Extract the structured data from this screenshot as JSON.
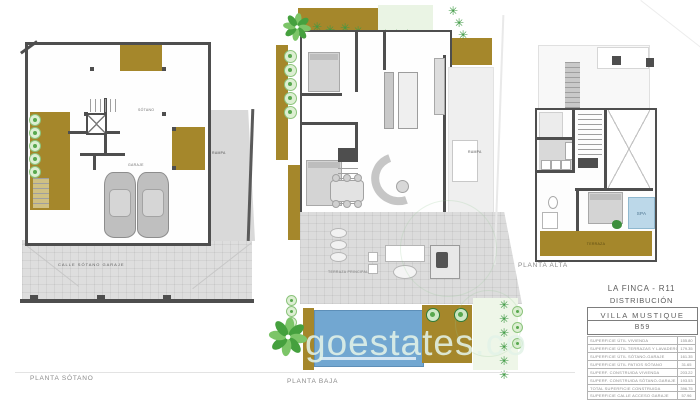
{
  "watermark": {
    "text": "goestates.co"
  },
  "icons": {
    "tree": "✳"
  },
  "plans": {
    "sotano": {
      "label": "PLANTA SÓTANO",
      "street": "CALLE SÓTANO GARAJE",
      "ramp": "RAMPA",
      "room_main": "SÓTANO",
      "room_garage": "GARAJE"
    },
    "baja": {
      "label": "PLANTA BAJA",
      "ramp": "RAMPA",
      "terrace": "TERRAZA PRINCIPAL"
    },
    "alta": {
      "label": "PLANTA ALTA",
      "spa": "SPA",
      "terrace": "TERRAZA"
    }
  },
  "title_block": {
    "project": "LA FINCA - R11",
    "subtitle": "DISTRIBUCIÓN",
    "villa_name": "VILLA MUSTIQUE",
    "unit": "B59",
    "areas_util": [
      {
        "label": "SUPERFICIE ÚTIL VIVIENDA",
        "value": "155.80"
      },
      {
        "label": "SUPERFICIE ÚTIL TERRAZAS Y LAVADERO",
        "value": "179.35"
      },
      {
        "label": "SUPERFICIE ÚTIL SÓTANO-GARAJE",
        "value": "161.35"
      },
      {
        "label": "SUPERFICIE ÚTIL PATIOS SÓTANO",
        "value": "31.65"
      }
    ],
    "areas_built": [
      {
        "label": "SUPERF. CONSTRUIDA VIVIENDA",
        "value": "203.22"
      },
      {
        "label": "SUPERF. CONSTRUIDA SÓTANO-GARAJE",
        "value": "193.53"
      },
      {
        "label": "TOTAL SUPERFICIE CONSTRUIDA",
        "value": "396.75"
      }
    ],
    "areas_other": [
      {
        "label": "SUPERFICIE CALLE ACCESO GARAJE",
        "value": "57.96"
      }
    ]
  },
  "colors": {
    "wall_gray": "#4e4e4e",
    "terrace_brown": "#a5872b",
    "pool_blue": "#72a7d1",
    "vegetation_green": "#3f9a44",
    "paving_gray": "#dcdcdc"
  }
}
